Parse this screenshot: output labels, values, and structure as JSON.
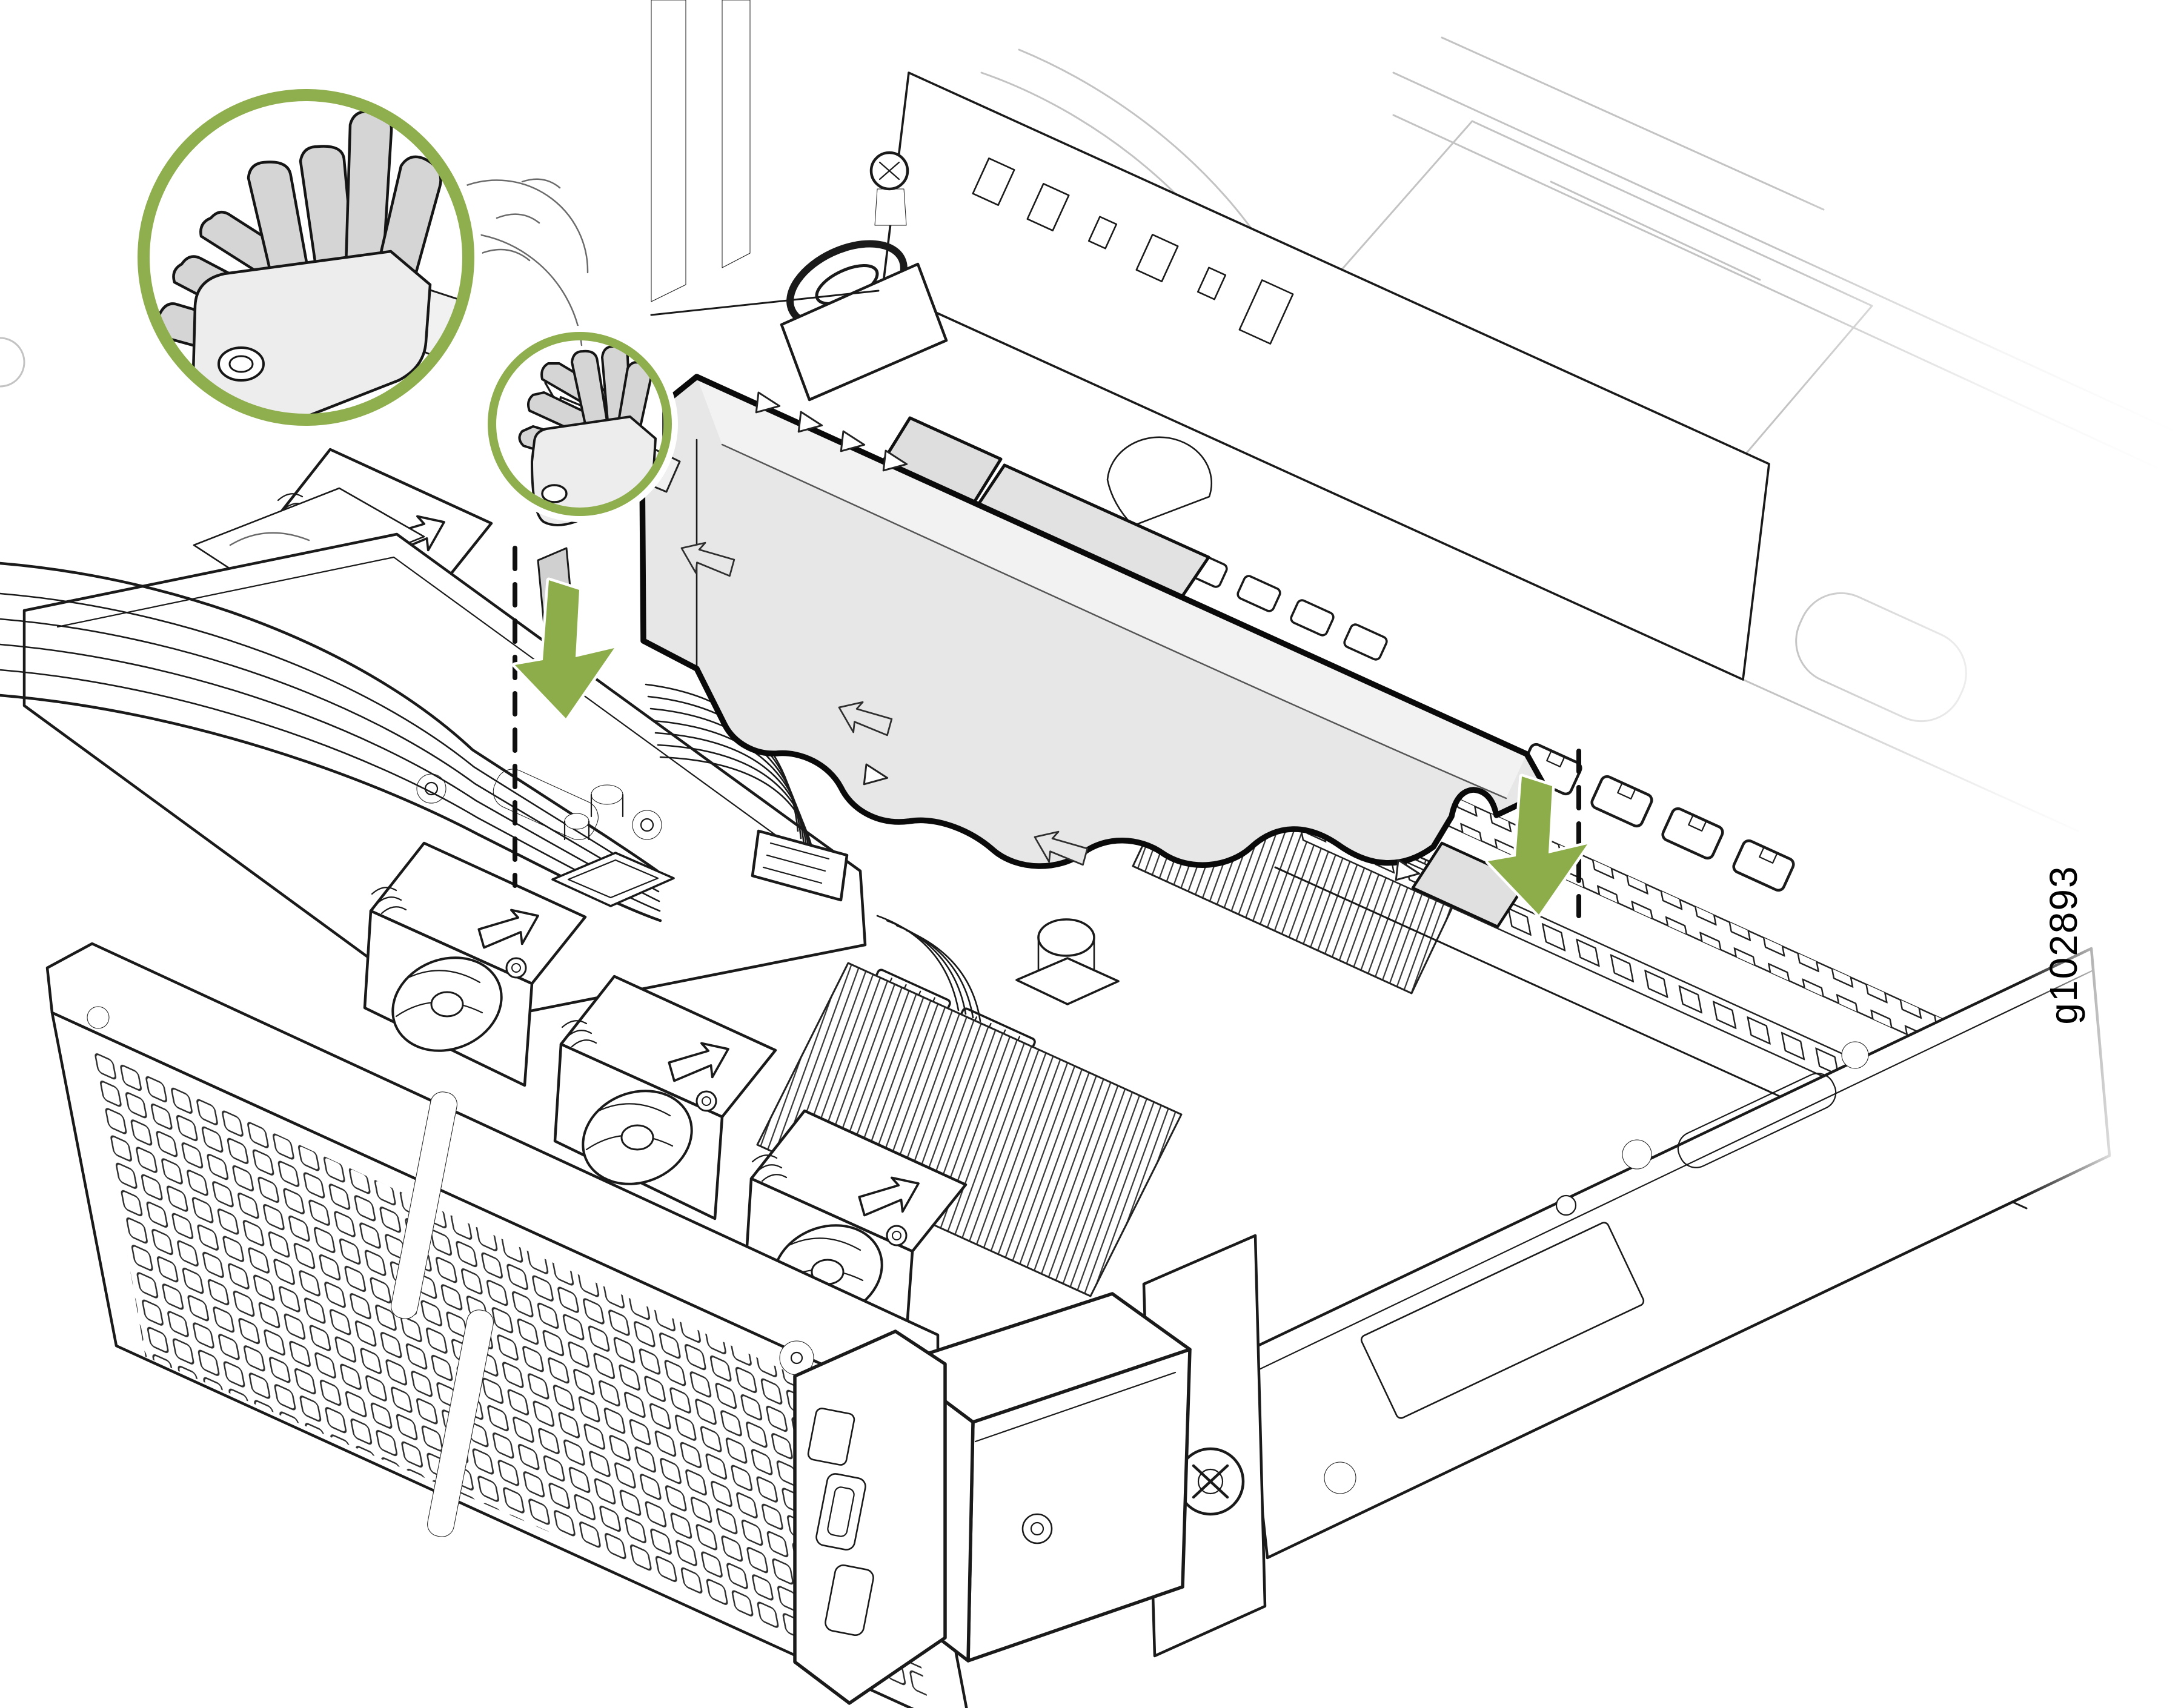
{
  "figure": {
    "label": "g102893"
  },
  "colors": {
    "accent_green": "#8FAE4D",
    "arrow_green": "#8CAD49",
    "duct_gray": "#e7e7e7",
    "duct_band_gray": "#f2f2f2",
    "cable_gray": "#d5d5d5",
    "plate_gray": "#ededed",
    "tab_gray": "#dedede",
    "line_black": "#1a1a1a",
    "line_faded": "#c3c3c3",
    "background": "#ffffff"
  },
  "annotations": {
    "callout_large_icon": "zoom-callout-circle",
    "callout_small_icon": "zoom-callout-circle",
    "arrow_left_icon": "green-down-arrow",
    "arrow_right_icon": "green-down-arrow",
    "guide_line_icon": "dashed-alignment-line",
    "duct_arrow_icon": "embossed-direction-arrow",
    "fan_arrow_icon": "airflow-direction-arrow",
    "triangle_marker_icon": "alignment-triangle-marker"
  },
  "components": [
    "server-chassis",
    "front-bezel",
    "cooling-fan-modules",
    "heatsink",
    "dimm-slots",
    "air-duct",
    "ribbon-cables",
    "front-panel-module"
  ]
}
